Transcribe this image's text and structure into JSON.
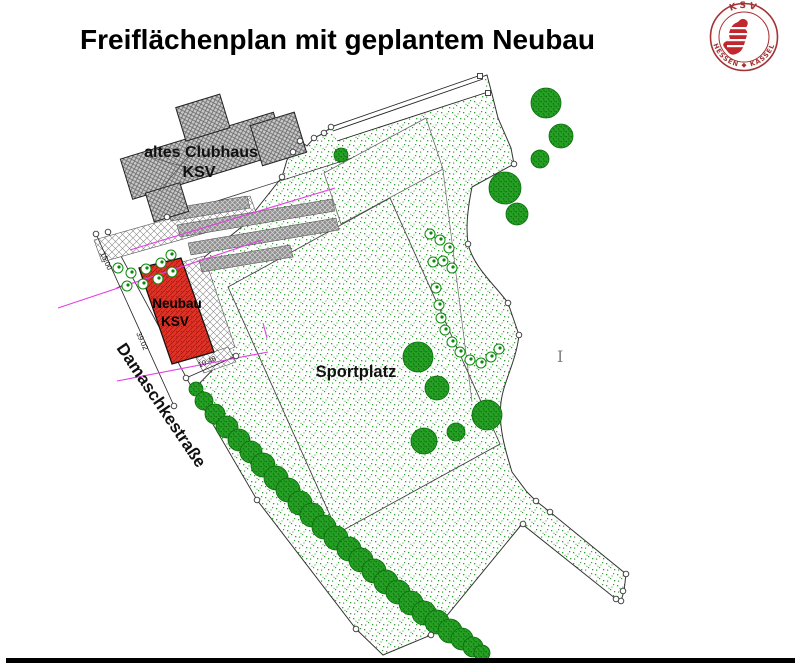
{
  "title": "Freiflächenplan mit geplantem Neubau",
  "logo": {
    "top": "KSV",
    "bottom": "HESSEN ◆ KASSEL",
    "ring_color": "#a23236",
    "lion_color": "#c1272d"
  },
  "labels": {
    "clubhouse_line1": "altes Clubhaus",
    "clubhouse_line2": "KSV",
    "neubau_line1": "Neubau",
    "neubau_line2": "KSV",
    "sportplatz": "Sportplatz",
    "street": "Damaschkestraße",
    "text_cursor": "I"
  },
  "dimensions": {
    "d_top": "15.00",
    "d_side": "39.02",
    "d_bottom": "10.48"
  },
  "colors": {
    "site_stipple_green": "#2da02d",
    "tree_green": "#26a126",
    "building_red": "#e03226",
    "magenta": "#e33fe3",
    "hatch_gray": "#c9c9c9",
    "footer_black": "#000000"
  },
  "plan": {
    "trees": [
      [
        546,
        103,
        15
      ],
      [
        561,
        136,
        12
      ],
      [
        540,
        159,
        9
      ],
      [
        505,
        188,
        16
      ],
      [
        517,
        214,
        11
      ],
      [
        341,
        155,
        7
      ],
      [
        418,
        357,
        15
      ],
      [
        437,
        388,
        12
      ],
      [
        487,
        415,
        15
      ],
      [
        424,
        441,
        13
      ],
      [
        456,
        432,
        9
      ],
      [
        196,
        389,
        7
      ],
      [
        204,
        401,
        9
      ],
      [
        215,
        414,
        10
      ],
      [
        227,
        427,
        11
      ],
      [
        239,
        440,
        11
      ],
      [
        251,
        452,
        11
      ],
      [
        263,
        465,
        12
      ],
      [
        276,
        478,
        12
      ],
      [
        288,
        490,
        12
      ],
      [
        300,
        503,
        12
      ],
      [
        312,
        515,
        12
      ],
      [
        324,
        527,
        12
      ],
      [
        336,
        538,
        12
      ],
      [
        349,
        549,
        12
      ],
      [
        361,
        560,
        12
      ],
      [
        374,
        571,
        12
      ],
      [
        386,
        582,
        12
      ],
      [
        398,
        592,
        12
      ],
      [
        411,
        603,
        12
      ],
      [
        424,
        613,
        12
      ],
      [
        437,
        622,
        12
      ],
      [
        450,
        631,
        12
      ],
      [
        462,
        639,
        11
      ],
      [
        473,
        647,
        10
      ],
      [
        482,
        653,
        8
      ]
    ],
    "bushes": [
      [
        118,
        268
      ],
      [
        131,
        273
      ],
      [
        146,
        269
      ],
      [
        161,
        263
      ],
      [
        171,
        255
      ],
      [
        127,
        286
      ],
      [
        143,
        284
      ],
      [
        158,
        279
      ],
      [
        172,
        272
      ],
      [
        430,
        234
      ],
      [
        440,
        240
      ],
      [
        449,
        248
      ],
      [
        433,
        262
      ],
      [
        443,
        261
      ],
      [
        452,
        268
      ],
      [
        436,
        288
      ],
      [
        439,
        305
      ],
      [
        441,
        318
      ],
      [
        445,
        330
      ],
      [
        452,
        342
      ],
      [
        460,
        352
      ],
      [
        470,
        360
      ],
      [
        481,
        363
      ],
      [
        491,
        357
      ],
      [
        499,
        349
      ]
    ],
    "markers_circle": [
      [
        96,
        234
      ],
      [
        174,
        406
      ],
      [
        108,
        232
      ],
      [
        167,
        217
      ],
      [
        282,
        177
      ],
      [
        293,
        152
      ],
      [
        300,
        141
      ],
      [
        314,
        138
      ],
      [
        324,
        133
      ],
      [
        331,
        127
      ],
      [
        514,
        164
      ],
      [
        468,
        244
      ],
      [
        508,
        303
      ],
      [
        519,
        335
      ],
      [
        523,
        524
      ],
      [
        536,
        501
      ],
      [
        550,
        512
      ],
      [
        626,
        574
      ],
      [
        623,
        591
      ],
      [
        621,
        601
      ],
      [
        616,
        599
      ],
      [
        257,
        500
      ],
      [
        356,
        629
      ],
      [
        431,
        635
      ],
      [
        186,
        378
      ],
      [
        236,
        356
      ]
    ],
    "markers_square": [
      [
        480,
        76
      ],
      [
        488,
        93
      ]
    ]
  }
}
